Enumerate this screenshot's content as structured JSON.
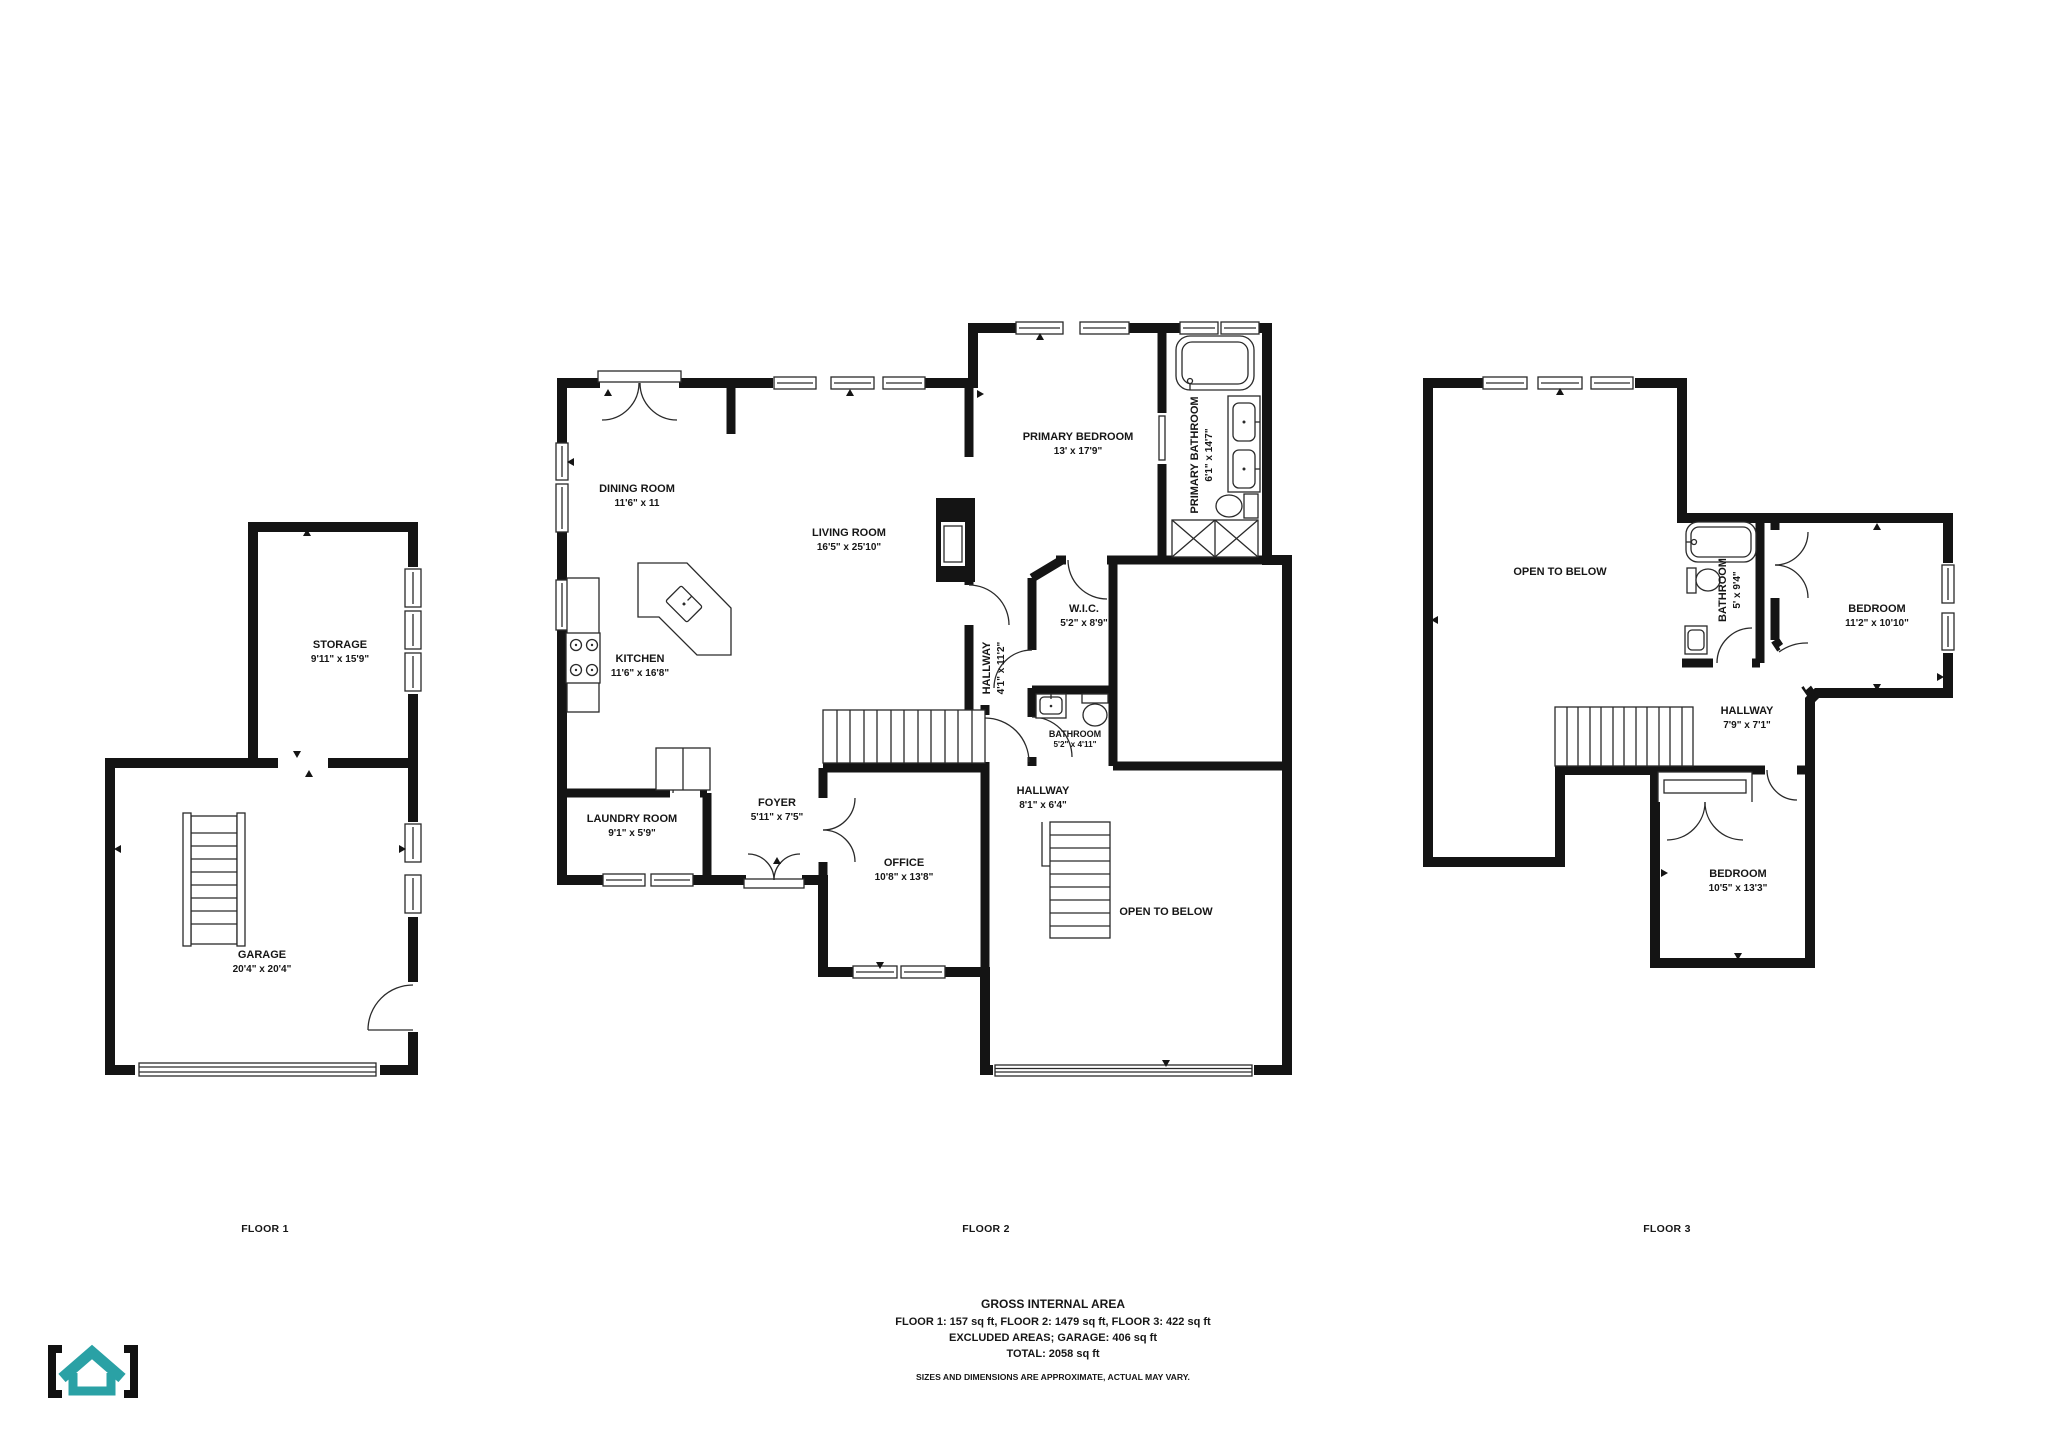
{
  "floors": [
    {
      "label": "FLOOR 1",
      "rooms": [
        {
          "name": "STORAGE",
          "dims": "9'11\" x 15'9\""
        },
        {
          "name": "GARAGE",
          "dims": "20'4\" x 20'4\""
        }
      ]
    },
    {
      "label": "FLOOR 2",
      "rooms": [
        {
          "name": "DINING ROOM",
          "dims": "11'6\" x 11"
        },
        {
          "name": "LIVING ROOM",
          "dims": "16'5\" x 25'10\""
        },
        {
          "name": "KITCHEN",
          "dims": "11'6\" x 16'8\""
        },
        {
          "name": "PRIMARY BEDROOM",
          "dims": "13' x 17'9\""
        },
        {
          "name": "PRIMARY BATHROOM",
          "dims": "6'1\" x 14'7\""
        },
        {
          "name": "W.I.C.",
          "dims": "5'2\" x 8'9\""
        },
        {
          "name": "HALLWAY",
          "dims": "4'1\" x 11'2\""
        },
        {
          "name": "BATHROOM",
          "dims": "5'2\" x 4'11\""
        },
        {
          "name": "LAUNDRY ROOM",
          "dims": "9'1\" x 5'9\""
        },
        {
          "name": "FOYER",
          "dims": "5'11\" x 7'5\""
        },
        {
          "name": "OFFICE",
          "dims": "10'8\" x 13'8\""
        },
        {
          "name": "HALLWAY",
          "dims": "8'1\" x 6'4\""
        },
        {
          "name": "OPEN TO BELOW",
          "dims": ""
        }
      ]
    },
    {
      "label": "FLOOR 3",
      "rooms": [
        {
          "name": "OPEN TO BELOW",
          "dims": ""
        },
        {
          "name": "BATHROOM",
          "dims": "5' x 9'4\""
        },
        {
          "name": "BEDROOM",
          "dims": "11'2\" x 10'10\""
        },
        {
          "name": "HALLWAY",
          "dims": "7'9\" x 7'1\""
        },
        {
          "name": "BEDROOM",
          "dims": "10'5\" x 13'3\""
        }
      ]
    }
  ],
  "footer": {
    "title": "GROSS INTERNAL AREA",
    "line1": "FLOOR 1: 157 sq ft, FLOOR 2: 1479 sq ft, FLOOR 3: 422 sq ft",
    "line2": "EXCLUDED AREAS; GARAGE: 406 sq ft",
    "line3": "TOTAL: 2058 sq ft",
    "disclaimer": "SIZES AND DIMENSIONS ARE APPROXIMATE, ACTUAL MAY VARY."
  },
  "logo": {
    "accent": "#2aa1a5",
    "bracket": "#111111"
  }
}
